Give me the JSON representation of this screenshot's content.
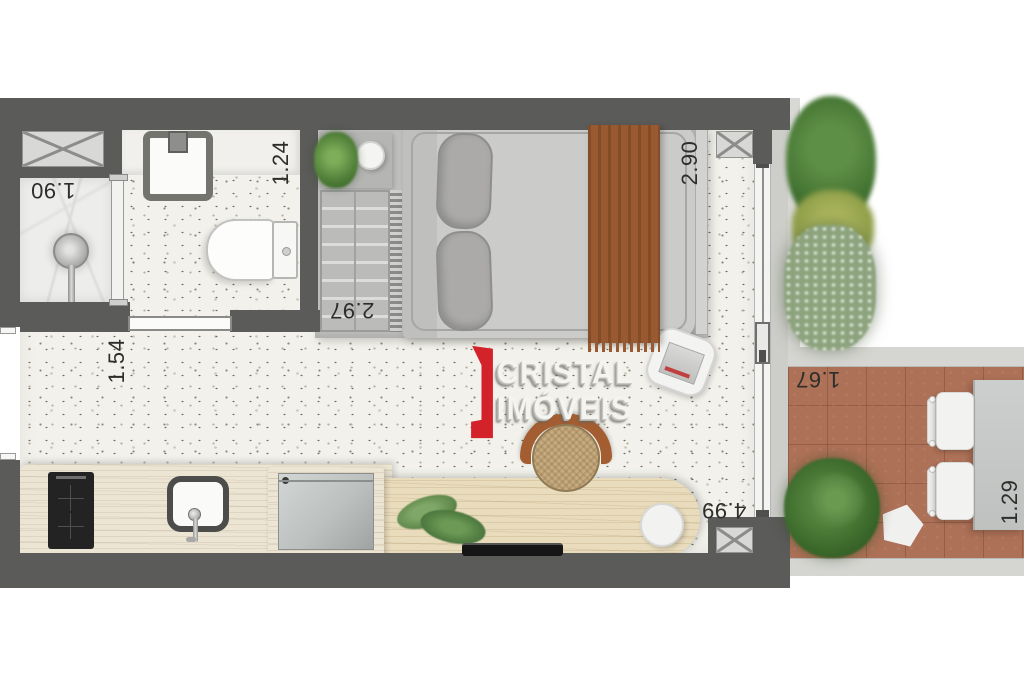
{
  "brand": {
    "line1": "CRISTAL",
    "line2": "IMÓVEIS",
    "accent_color": "#d3222a"
  },
  "dimensions": {
    "shower": "1.90",
    "bathroom": "1.24",
    "wardrobe": "2.97",
    "bedroom": "2.90",
    "hall": "1.54",
    "living": "4.99",
    "balcony_depth": "1.67",
    "balcony_table": "1.29"
  },
  "colors": {
    "wall": "#5b5b59",
    "terrazzo_floor": "#f2f1eb",
    "balcony_tile": "#ad7157",
    "wood_counter": "#ece5d4",
    "bed_runner": "#9a5a31"
  }
}
